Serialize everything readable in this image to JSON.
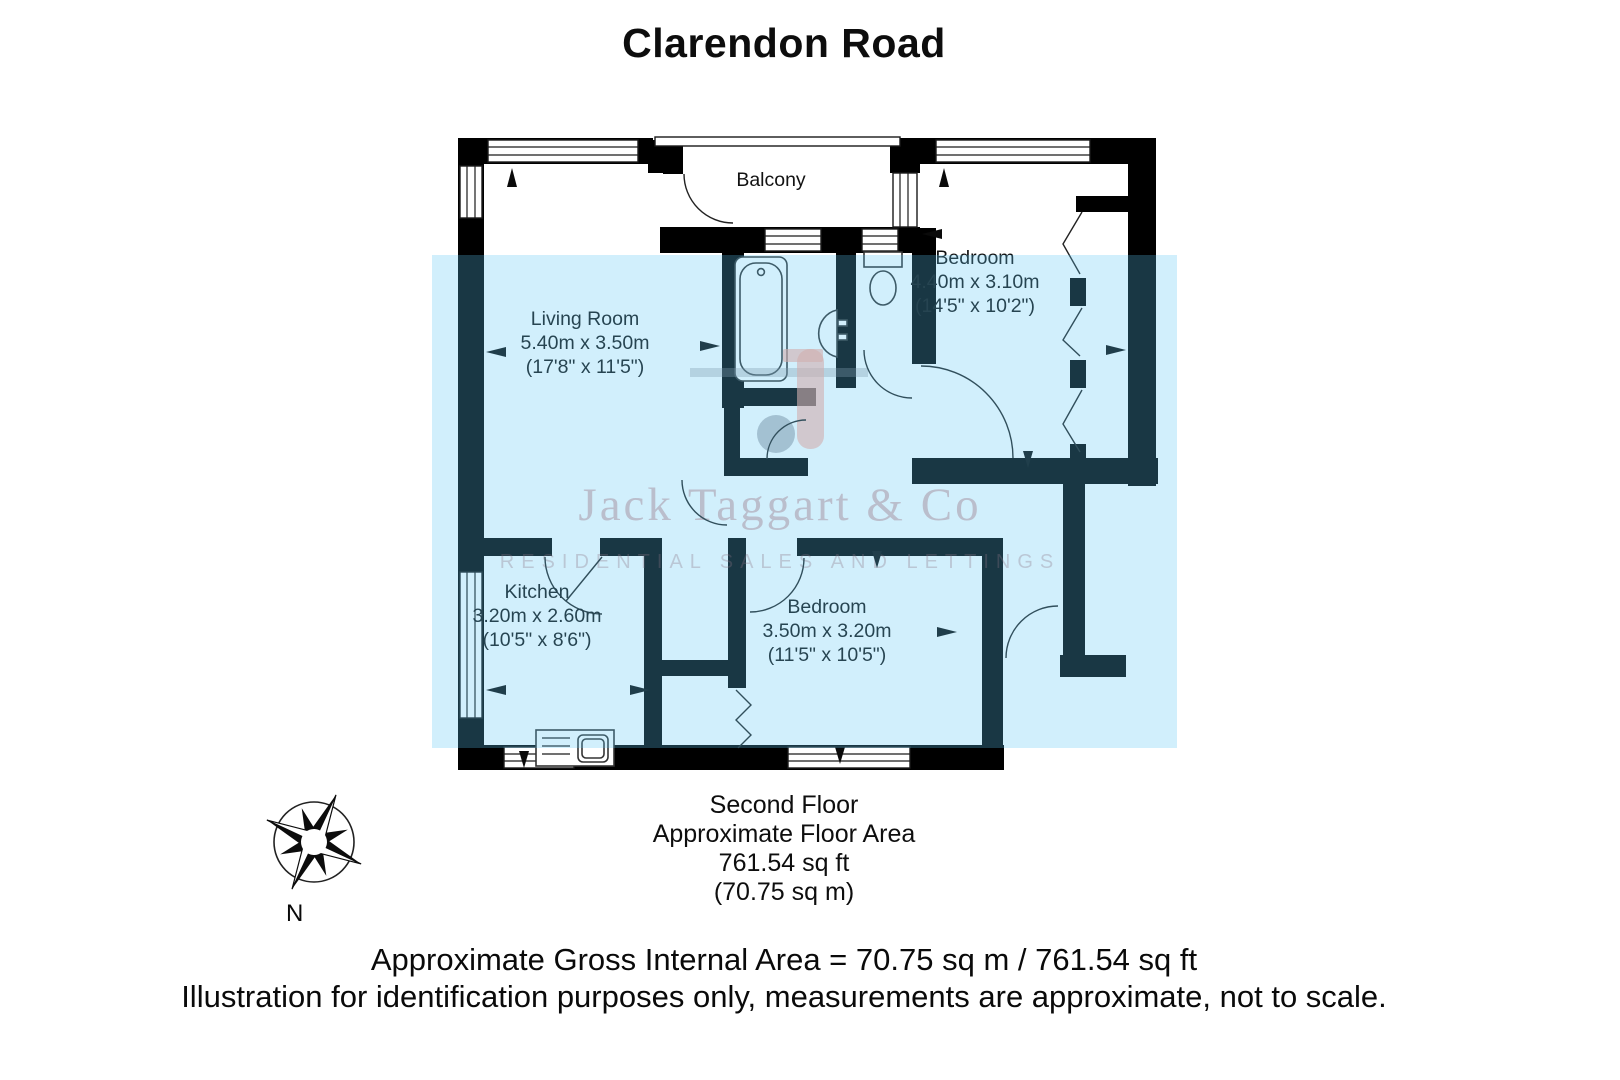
{
  "title": "Clarendon Road",
  "plan": {
    "balcony": "Balcony",
    "rooms": [
      {
        "name": "Living Room",
        "metric": "5.40m x 3.50m",
        "imperial": "(17'8\" x 11'5\")"
      },
      {
        "name": "Bedroom",
        "metric": "4.40m x 3.10m",
        "imperial": "(14'5\" x 10'2\")"
      },
      {
        "name": "Kitchen",
        "metric": "3.20m x 2.60m",
        "imperial": "(10'5\" x 8'6\")"
      },
      {
        "name": "Bedroom",
        "metric": "3.50m x 3.20m",
        "imperial": "(11'5\" x 10'5\")"
      }
    ]
  },
  "compass": {
    "label": "N"
  },
  "watermark": {
    "name": "Jack Taggart & Co",
    "tagline": "RESIDENTIAL SALES AND LETTINGS"
  },
  "summary": {
    "floor": "Second Floor",
    "caption": "Approximate Floor Area",
    "area_imperial": "761.54 sq ft",
    "area_metric": "(70.75 sq m)"
  },
  "footer": {
    "line1": "Approximate Gross Internal Area = 70.75 sq m / 761.54 sq ft",
    "line2": "Illustration for identification purposes only, measurements are approximate, not to scale."
  },
  "colors": {
    "wall": "#000000",
    "overlay_rgba": "rgba(88,198,246,0.28)",
    "logo_pink": "#ffa694",
    "logo_grey": "#8a8a96"
  }
}
